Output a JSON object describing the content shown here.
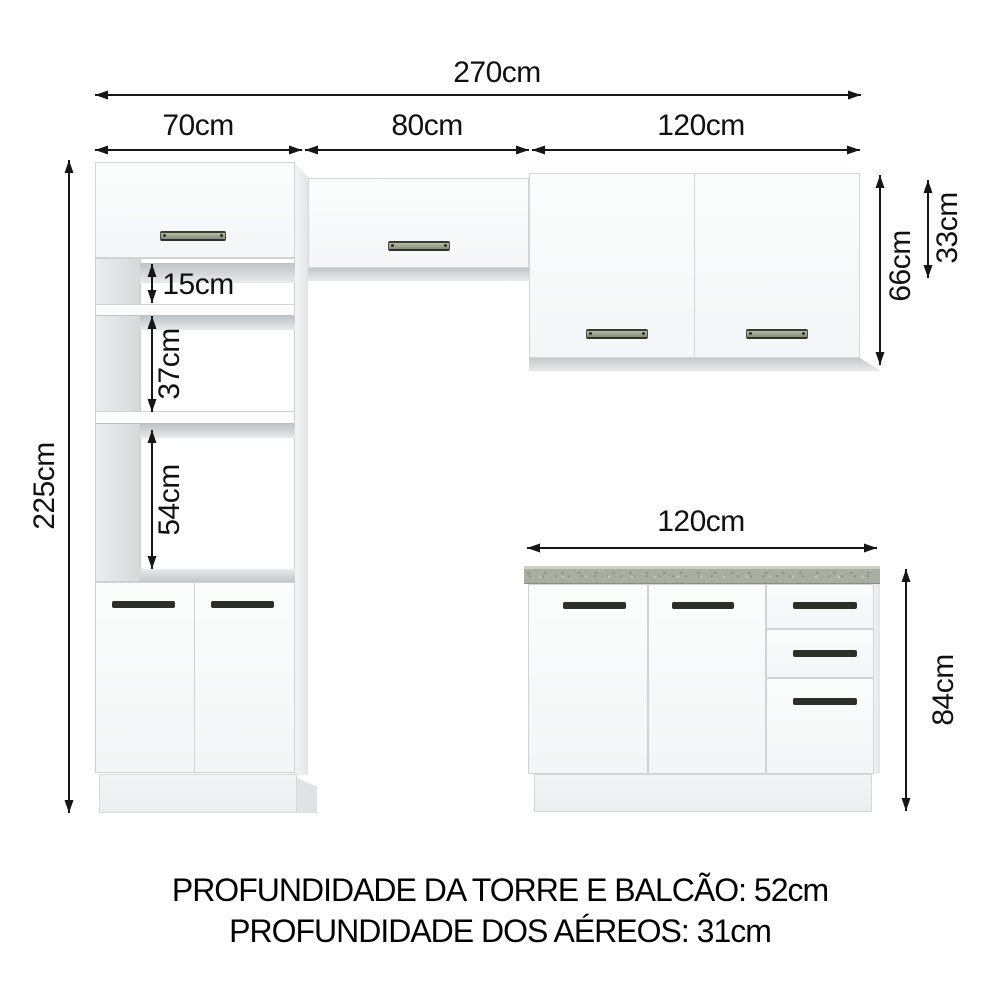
{
  "labels": {
    "total_width": "270cm",
    "tower_width": "70cm",
    "middle_width": "80cm",
    "upper_right_width": "120cm",
    "tower_height": "225cm",
    "tower_gap_top": "15cm",
    "tower_gap_middle": "37cm",
    "tower_gap_bottom": "54cm",
    "upper_cabinet_height": "66cm",
    "upper_middle_cabinet_height": "33cm",
    "counter_width": "120cm",
    "counter_height": "84cm"
  },
  "notes": {
    "depth_tower_counter": "PROFUNDIDADE DA TORRE E BALCÃO: 52cm",
    "depth_uppers": "PROFUNDIDADE DOS AÉREOS: 31cm"
  },
  "colors": {
    "countertop": "#a9ae9f",
    "cabinet_face": "#fafbfb",
    "handle_dark": "#2d2d29",
    "handle_light": "#8d927c",
    "dimension_line": "#161616"
  }
}
